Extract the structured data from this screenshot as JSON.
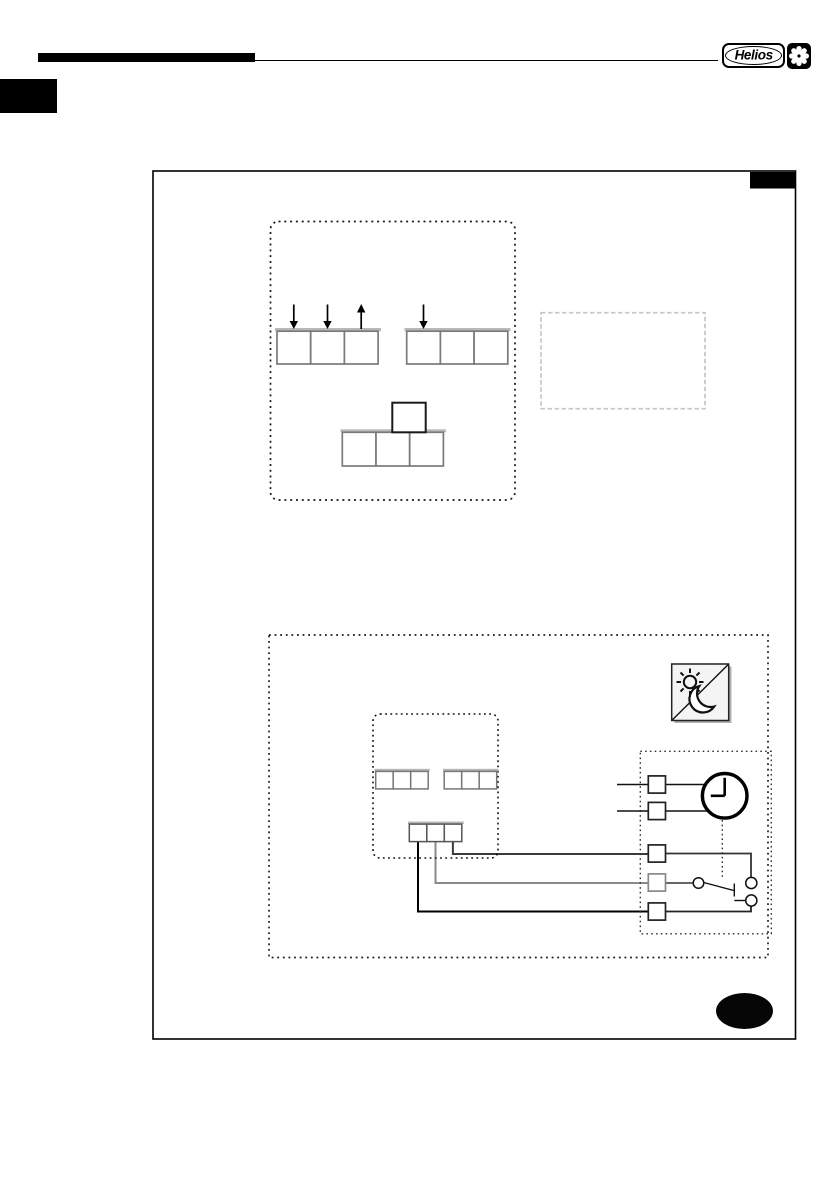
{
  "header": {
    "logo_text": "Helios",
    "logo_mark_icon": "fan-impeller-icon",
    "rule": "header-rule"
  },
  "page_marks": {
    "chapter_tab": "black-chapter-tab",
    "frame_corner_tab": "black-corner-tab",
    "footer_oval": "black-footer-oval"
  },
  "colors": {
    "ink": "#000000",
    "block_border": "#7a7a7a",
    "block_rail": "#b8b8b8",
    "note_box_border": "#c6c6c6",
    "wire_mid_gray": "#8a8a8a",
    "wire_dark_gray": "#3a3a3a",
    "icon_fill": "#f4f4f4"
  },
  "diagram": {
    "controller_box": {
      "blocks": [
        {
          "name": "terminal-block-a",
          "cells": 3,
          "arrows": [
            "down",
            "down",
            "up"
          ]
        },
        {
          "name": "terminal-block-b",
          "cells": 3,
          "arrows": [
            "down",
            "none",
            "none"
          ]
        }
      ],
      "t_block": {
        "top_cells": 1,
        "bottom_cells": 3
      }
    },
    "note_box": {
      "content": ""
    },
    "wiring_box": {
      "mode_icon": "day-night-icon",
      "mode_icon_parts": [
        "sun-icon",
        "moon-icon",
        "diagonal-divider"
      ],
      "device_box": {
        "upper_blocks": [
          {
            "cells": 3
          },
          {
            "cells": 3
          }
        ],
        "lower_block": {
          "cells": 3
        },
        "wire_count": 3
      },
      "timer_box": {
        "terminal_count": 5,
        "clock_icon": "clock-icon",
        "clock_hands": [
          "12",
          "9"
        ],
        "switch": "changeover-switch",
        "link": "dotted-mechanical-link",
        "lead_in_wires": 2
      }
    }
  }
}
